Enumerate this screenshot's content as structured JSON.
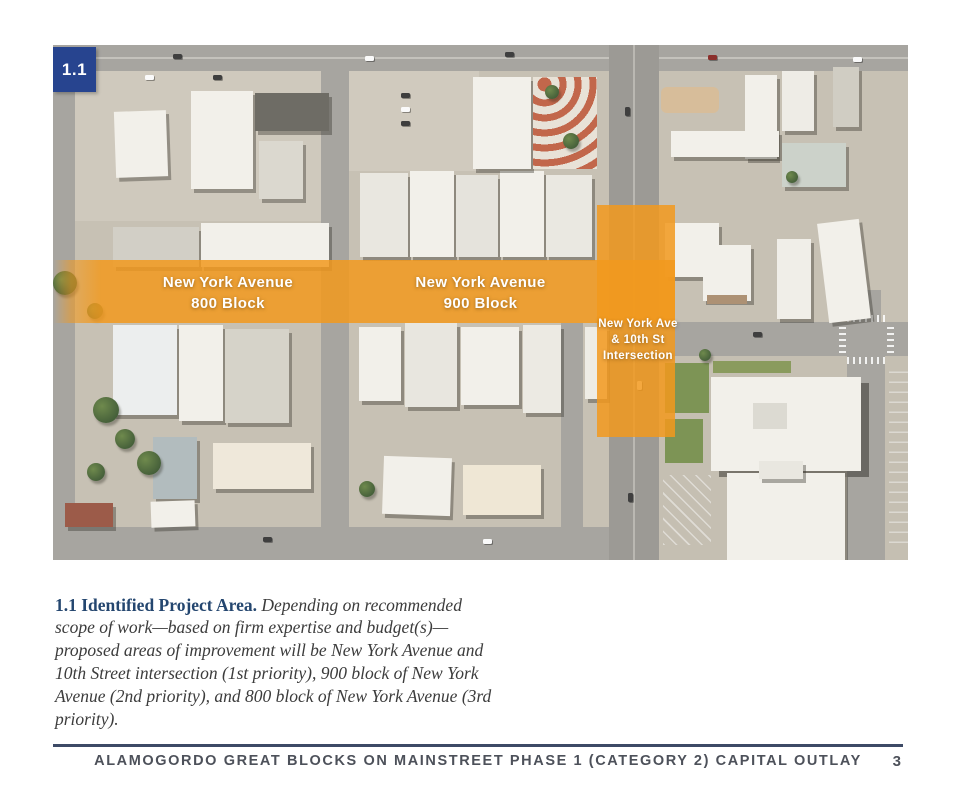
{
  "badge": "1.1",
  "map": {
    "labels": {
      "block800": [
        "New York Avenue",
        "800 Block"
      ],
      "block900": [
        "New York Avenue",
        "900 Block"
      ],
      "intersection": [
        "New York Ave",
        "& 10th St",
        "Intersection"
      ]
    },
    "overlay_color": "#f2991d"
  },
  "caption": {
    "lead": "1.1 Identified Project Area.",
    "body": " Depending on recommended scope of work—based on firm expertise and budget(s)—proposed areas of improvement will be New York Avenue and 10th Street intersection (1st priority), 900 block of New York Avenue (2nd priority), and 800 block of New York Avenue (3rd priority)."
  },
  "footer": {
    "title": "ALAMOGORDO GREAT BLOCKS ON MAINSTREET PHASE 1 (CATEGORY 2) CAPITAL OUTLAY",
    "page_number": "3"
  },
  "colors": {
    "badge_blue": "#27448f",
    "caption_blue": "#24466f",
    "divider": "#3d4a66",
    "footer_text": "#4d515a"
  }
}
